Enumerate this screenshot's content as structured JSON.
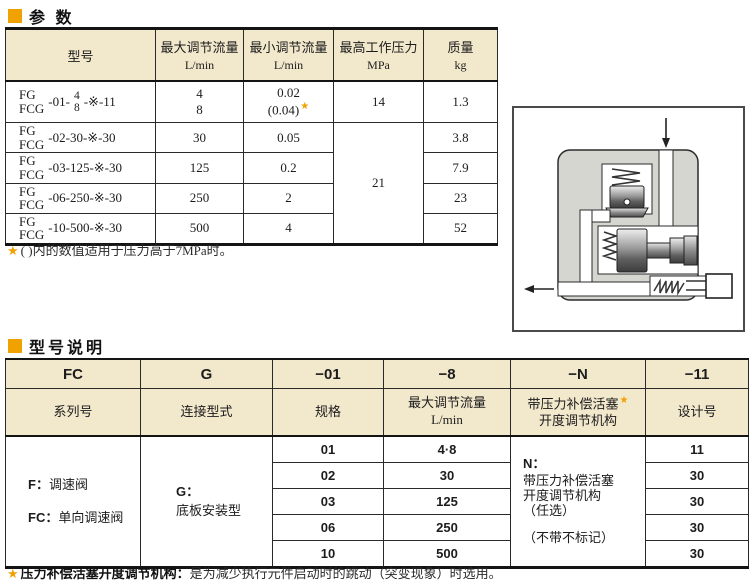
{
  "accent_color": "#F0A202",
  "header_bg": "#F2E8CC",
  "section_params": {
    "title": "参 数",
    "columns": [
      {
        "title": "型号",
        "unit": ""
      },
      {
        "title": "最大调节流量",
        "unit": "L/min"
      },
      {
        "title": "最小调节流量",
        "unit": "L/min"
      },
      {
        "title": "最高工作压力",
        "unit": "MPa"
      },
      {
        "title": "质量",
        "unit": "kg"
      }
    ],
    "rows": [
      {
        "model_series": "FG\nFCG",
        "model_code_pre": "-01-",
        "model_frac_num": "4",
        "model_frac_den": "8",
        "model_code_post": "-※-11",
        "max_flow": "4\n8",
        "min_flow_line1": "0.02",
        "min_flow_line2": "(0.04)",
        "min_flow_star": "★",
        "pressure": "14",
        "mass": "1.3"
      },
      {
        "model_series": "FG\nFCG",
        "model_code": "-02-30-※-30",
        "max_flow": "30",
        "min_flow": "0.05",
        "mass": "3.8"
      },
      {
        "model_series": "FG\nFCG",
        "model_code": "-03-125-※-30",
        "max_flow": "125",
        "min_flow": "0.2",
        "mass": "7.9"
      },
      {
        "model_series": "FG\nFCG",
        "model_code": "-06-250-※-30",
        "max_flow": "250",
        "min_flow": "2",
        "mass": "23"
      },
      {
        "model_series": "FG\nFCG",
        "model_code": "-10-500-※-30",
        "max_flow": "500",
        "min_flow": "4",
        "mass": "52"
      }
    ],
    "pressure_merged": "21",
    "footnote_star": "★",
    "footnote": "(  )内的数值适用于压力高于7MPa时。"
  },
  "section_model": {
    "title": "型号说明",
    "header_codes": [
      "FC",
      "G",
      "−01",
      "−8",
      "−N",
      "−11"
    ],
    "header_labels": {
      "series": "系列号",
      "connection": "连接型式",
      "size": "规格",
      "flow_line1": "最大调节流量",
      "flow_line2": "L/min",
      "compensator_line1": "带压力补偿活塞",
      "compensator_star": "★",
      "compensator_line2": "开度调节机构",
      "design": "设计号"
    },
    "body": {
      "series_item1_code": "F：",
      "series_item1_desc": "调速阀",
      "series_item2_code": "FC：",
      "series_item2_desc": "单向调速阀",
      "connection_code": "G：",
      "connection_desc": "底板安装型",
      "sizes": [
        "01",
        "02",
        "03",
        "06",
        "10"
      ],
      "flows": [
        "4·8",
        "30",
        "125",
        "250",
        "500"
      ],
      "compensator_code": "N：",
      "compensator_desc": "带压力补偿活塞\n开度调节机构\n（任选）",
      "compensator_note": "（不带不标记）",
      "designs": [
        "11",
        "30",
        "30",
        "30",
        "30"
      ]
    },
    "footnote_star": "★",
    "footnote_bold": "压力补偿活塞开度调节机构：",
    "footnote_text": "是为减少执行元件启动时的跳动（突变现象）时选用。"
  }
}
